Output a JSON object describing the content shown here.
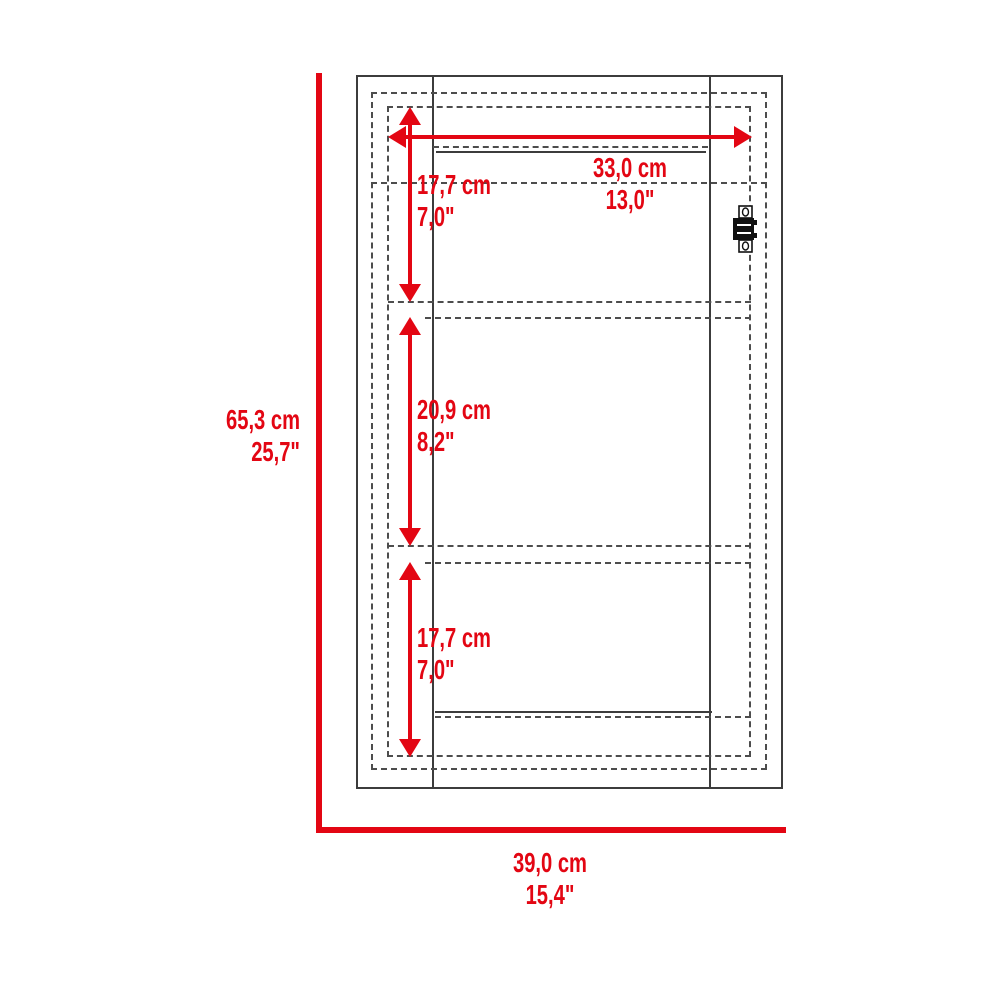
{
  "diagram": {
    "type": "furniture-dimension-diagram",
    "subject": "wall-cabinet-front-elevation",
    "colors": {
      "dimension_red": "#e30613",
      "outline_dark": "#3c3c3c",
      "dashed_gray": "#4d4d4d",
      "background": "#ffffff"
    },
    "labels": {
      "overall_height": {
        "cm": "65,3 cm",
        "inches": "25,7\""
      },
      "overall_width": {
        "cm": "39,0 cm",
        "inches": "15,4\""
      },
      "interior_width": {
        "cm": "33,0 cm",
        "inches": "13,0\""
      },
      "top_section_height": {
        "cm": "17,7 cm",
        "inches": "7,0\""
      },
      "middle_section_height": {
        "cm": "20,9 cm",
        "inches": "8,2\""
      },
      "bottom_section_height": {
        "cm": "17,7 cm",
        "inches": "7,0\""
      }
    },
    "icons": {
      "hinge": "cabinet-hinge"
    }
  }
}
